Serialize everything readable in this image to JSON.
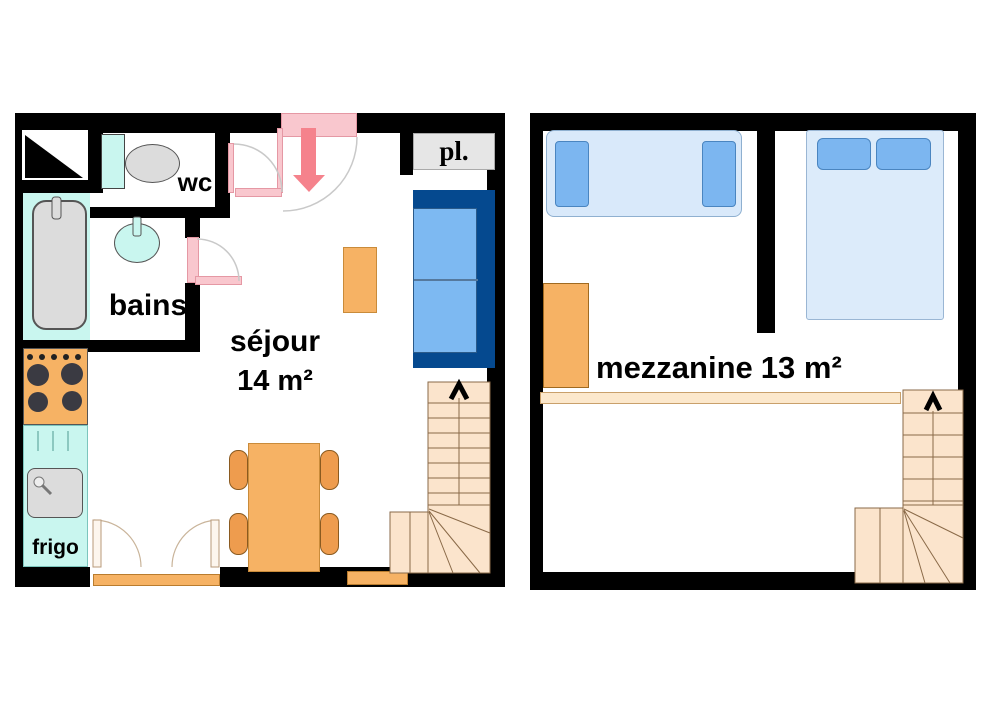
{
  "document_title": "apartment floor plan, two levels",
  "floor1": {
    "labels": {
      "wc": "wc",
      "bains": "bains",
      "frigo": "frigo",
      "sejour_name": "séjour",
      "sejour_area": "14 m²",
      "placard": "pl."
    }
  },
  "floor2": {
    "labels": {
      "mezzanine_name": "mezzanine",
      "mezzanine_area": "13 m²"
    }
  },
  "colors": {
    "wall": "#000000",
    "door_pink": "#f9c7ce",
    "entry_arrow_salmon": "#f5828c",
    "bath_cyan": "#c9f6ef",
    "fixture_gray": "#dcdcdc",
    "furniture_orange": "#f6b264",
    "chair_orange": "#ee9c4e",
    "stair_fill": "#fbe4cc",
    "stair_line": "#8a6a48",
    "sofa_navy": "#05498f",
    "sofa_cushion_blue": "#7db9f2",
    "bed_fill": "#d9e9fa",
    "pillow_blue": "#7cb6f0",
    "closet_gray": "#e6e6e6",
    "railing_fill": "#fce8cc"
  }
}
